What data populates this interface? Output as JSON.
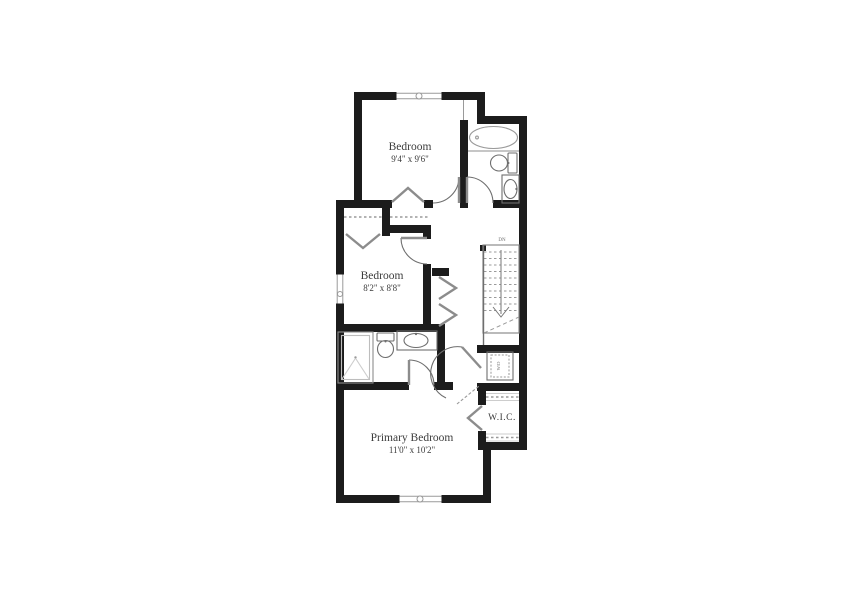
{
  "palette": {
    "background": "#ffffff",
    "wall": "#1c1c1c",
    "fixture_line": "#6e6e6e",
    "light_line": "#9a9a9a",
    "door_line": "#8c8c8c",
    "text": "#3c3c3c"
  },
  "floor_plan": {
    "bedroom_top": {
      "name": "Bedroom",
      "dimensions": "9'4\" x 9'6\""
    },
    "bedroom_middle": {
      "name": "Bedroom",
      "dimensions": "8'2\" x 8'8\""
    },
    "primary_bedroom": {
      "name": "Primary Bedroom",
      "dimensions": "11'0\" x 10'2\""
    },
    "walk_in_closet": {
      "label": "W.I.C."
    },
    "stairs": {
      "label": "DN"
    },
    "laundry": {
      "label": "W/D"
    }
  }
}
